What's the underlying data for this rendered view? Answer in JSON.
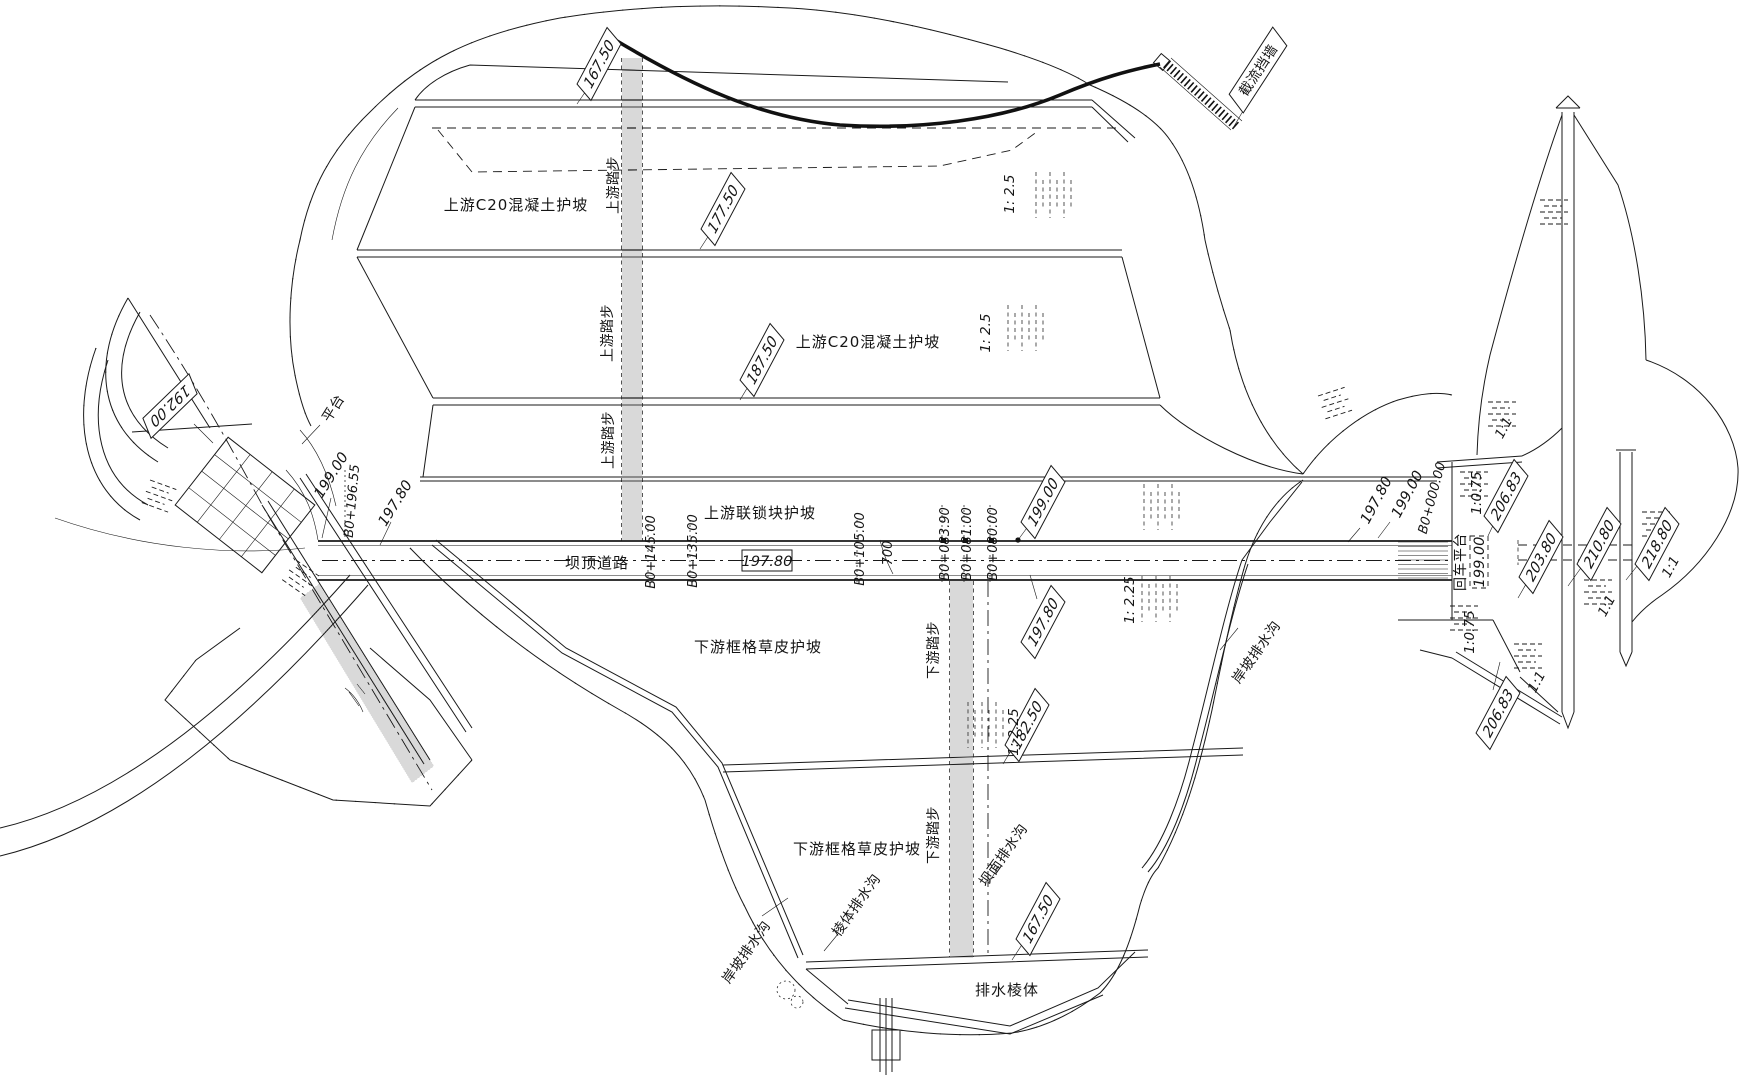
{
  "drawing": {
    "labels": {
      "usConcrete1": "上游C20混凝土护坡",
      "usConcrete2": "上游C20混凝土护坡",
      "usInterlock": "上游联锁块护坡",
      "crestRoad": "坝顶道路",
      "dsGrass1": "下游框格草皮护坡",
      "dsGrass2": "下游框格草皮护坡",
      "drainPrismBody": "排水棱体",
      "stepsUpstream": "上游踏步",
      "stepsDownstream": "下游踏步",
      "drainBankLeft": "岸坡排水沟",
      "drainBankRight": "岸坡排水沟",
      "drainDamFace": "坝面排水沟",
      "drainPrismDitch": "棱体排水沟",
      "closureWall": "截流挡墙",
      "platform": "平台",
      "turnPlatform": "回车平台",
      "turnPlatformElev": "199.00",
      "crestElevBox": "197.80",
      "crestWidth": "700"
    },
    "flags": {
      "usBermTop": "167.50",
      "usBermMid": "177.50",
      "usBermLow": "187.50",
      "crestUsEdge": "199.00",
      "crestDsEdge": "197.80",
      "dsBermUpper": "182.50",
      "dsBermLower": "167.50",
      "spillwayWing": "192.00",
      "rightAbutUpper": "206.83",
      "rightAbutLower": "206.83",
      "culvertFloor": "203.80",
      "wallCrest": "210.80",
      "rightSlopeTop": "218.80"
    },
    "stations": {
      "s145": "B0+145.00",
      "s135": "B0+135.00",
      "s105": "B0+105.00",
      "s83": "B0+083.90",
      "s81": "B0+081.00",
      "s80": "B0+080.00",
      "s0": "B0+000.00",
      "s196": "B0+196.55"
    },
    "spotElevations": {
      "leftUs": "199.00",
      "leftCrest": "197.80",
      "rightCrest": "197.80",
      "rightUs": "199.00"
    },
    "slopes": {
      "us1": "1: 2.5",
      "us2": "1: 2.5",
      "ds1": "1: 2.25",
      "ds2": "1: 2.25",
      "r075a": "1:0.75",
      "r075b": "1:0.75",
      "r11a": "1:1",
      "r11b": "1:1",
      "r11c": "1:1",
      "r11d": "1:1"
    }
  }
}
